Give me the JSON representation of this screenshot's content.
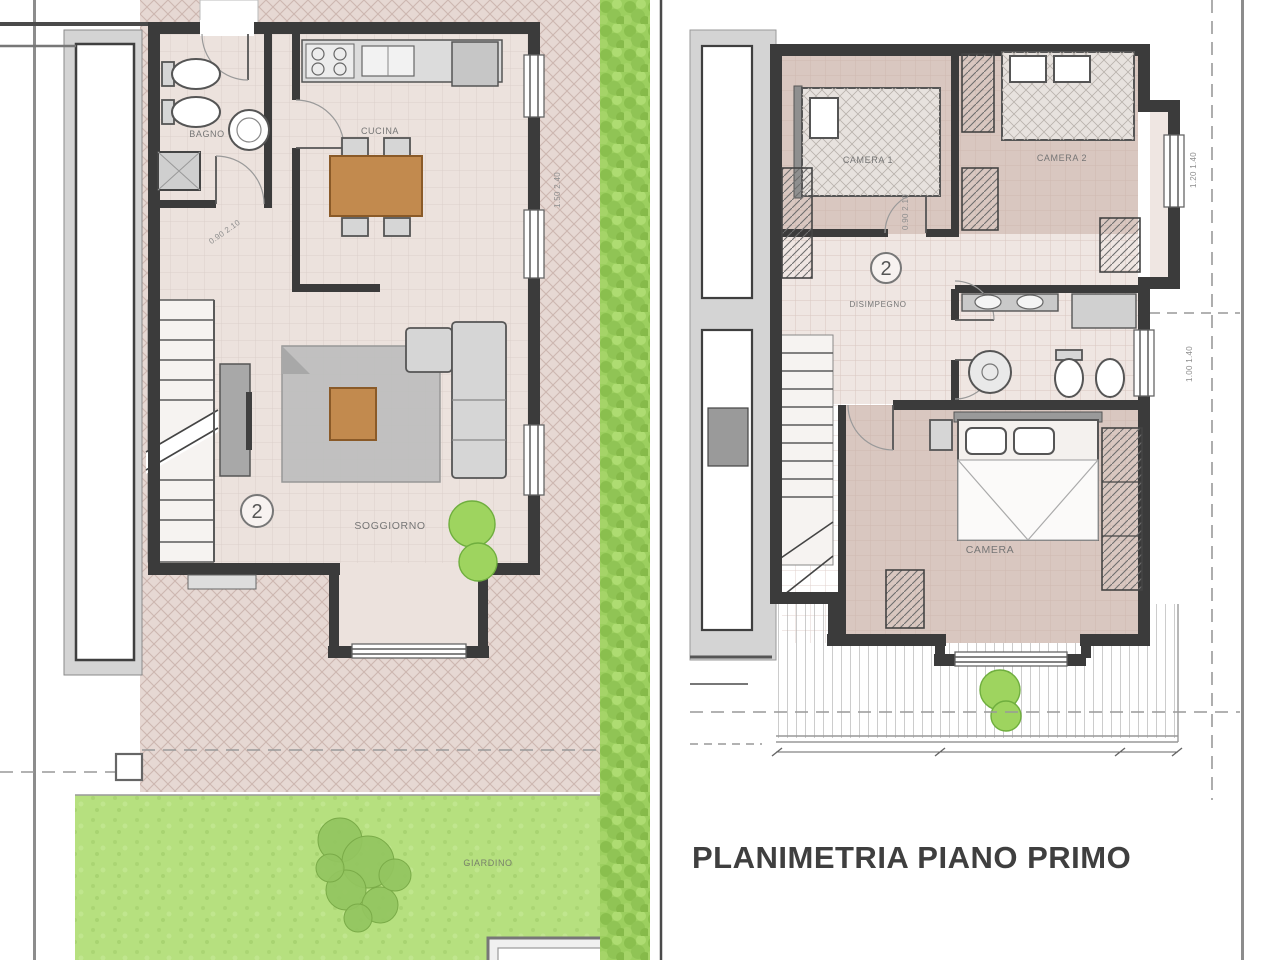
{
  "sheet": {
    "title": "PLANIMETRIA PIANO PRIMO"
  },
  "ground_floor": {
    "unit_marker": "2",
    "rooms": [
      {
        "id": "bagno",
        "label": "BAGNO"
      },
      {
        "id": "cucina",
        "label": "CUCINA"
      },
      {
        "id": "soggiorno",
        "label": "SOGGIORNO"
      },
      {
        "id": "giardino",
        "label": "GIARDINO"
      }
    ]
  },
  "first_floor": {
    "unit_marker": "2",
    "rooms": [
      {
        "id": "camera-1",
        "label": "CAMERA 1"
      },
      {
        "id": "camera-2",
        "label": "CAMERA 2"
      },
      {
        "id": "disimpegno",
        "label": "DISIMPEGNO"
      },
      {
        "id": "camera",
        "label": "CAMERA"
      }
    ]
  },
  "dimensions": [
    {
      "id": "gf-french-window",
      "text": "1.50 2.40"
    },
    {
      "id": "ff-window-camera2",
      "text": "1.20 1.40"
    },
    {
      "id": "ff-window-bagno",
      "text": "1.00 1.40"
    },
    {
      "id": "gf-door",
      "text": "0.90 2.10"
    },
    {
      "id": "ff-door",
      "text": "0.90 2.10"
    }
  ],
  "colors": {
    "wall": "#3b3b3b",
    "paving": "#e6d8d3",
    "garden": "#b6e07f",
    "hedge": "#9ccf5f",
    "bedroom_floor": "#d9c7c0",
    "living_floor": "#ece2dd",
    "wood_furniture": "#c28a4e",
    "gray_furniture": "#d6d6d6",
    "title_text": "#3f3f3f"
  }
}
